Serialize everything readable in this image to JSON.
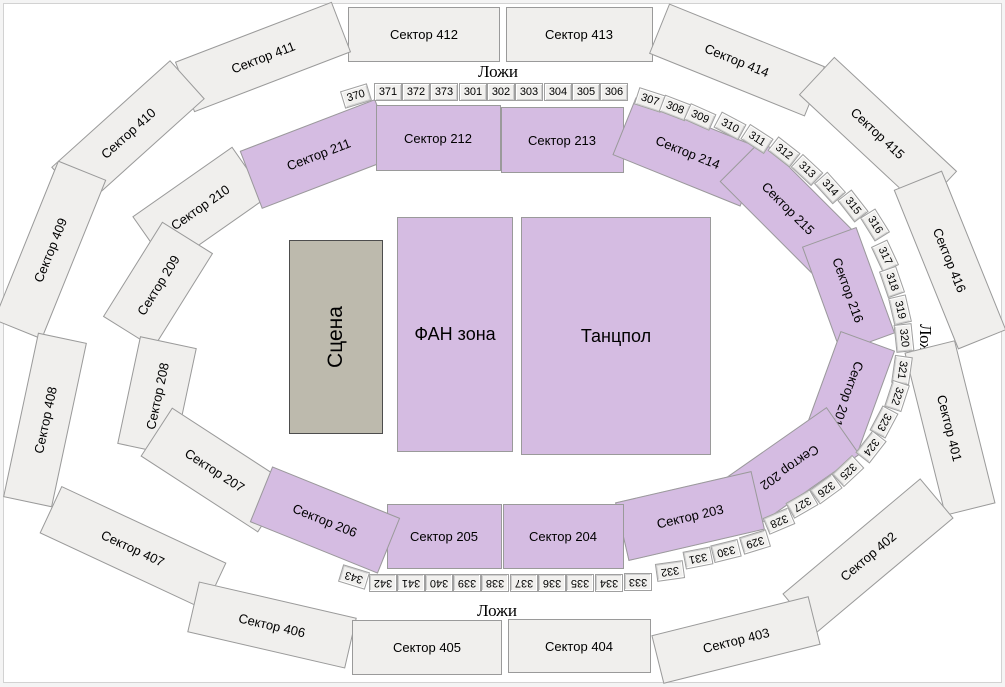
{
  "venue_map": {
    "lodges_label_top": "Ложи",
    "lodges_label_bottom": "Ложи",
    "lodges_label_right": "Ложи",
    "stage_label": "Сцена",
    "fan_zone_label": "ФАН зона",
    "dance_floor_label": "Танцпол",
    "outer_sectors": [
      "Сектор 412",
      "Сектор 413",
      "Сектор 411",
      "Сектор 414",
      "Сектор 410",
      "Сектор 415",
      "Сектор 409",
      "Сектор 416",
      "Сектор 408",
      "Сектор 401",
      "Сектор 407",
      "Сектор 402",
      "Сектор 406",
      "Сектор 403",
      "Сектор 405",
      "Сектор 404"
    ],
    "inner_sectors_unavailable": [
      "Сектор 210",
      "Сектор 209",
      "Сектор 208",
      "Сектор 207"
    ],
    "inner_sectors_available": [
      "Сектор 211",
      "Сектор 212",
      "Сектор 213",
      "Сектор 214",
      "Сектор 215",
      "Сектор 216",
      "Сектор 201",
      "Сектор 202",
      "Сектор 203",
      "Сектор 204",
      "Сектор 205",
      "Сектор 206"
    ],
    "lodges": [
      "370",
      "371",
      "372",
      "373",
      "301",
      "302",
      "303",
      "304",
      "305",
      "306",
      "307",
      "308",
      "309",
      "310",
      "311",
      "312",
      "313",
      "314",
      "315",
      "316",
      "317",
      "318",
      "319",
      "320",
      "321",
      "322",
      "323",
      "324",
      "325",
      "326",
      "327",
      "328",
      "329",
      "330",
      "331",
      "332",
      "337",
      "338",
      "339",
      "340",
      "341",
      "342",
      "343"
    ],
    "lodges_bottom_row": [
      "333",
      "334",
      "335",
      "336"
    ],
    "colors": {
      "available_fill": "#d5bce2",
      "unavailable_fill": "#f0efed",
      "stage_fill": "#bdbaad",
      "lodge_fill": "#f1f0ee",
      "outline": "#9a9a9a"
    }
  }
}
